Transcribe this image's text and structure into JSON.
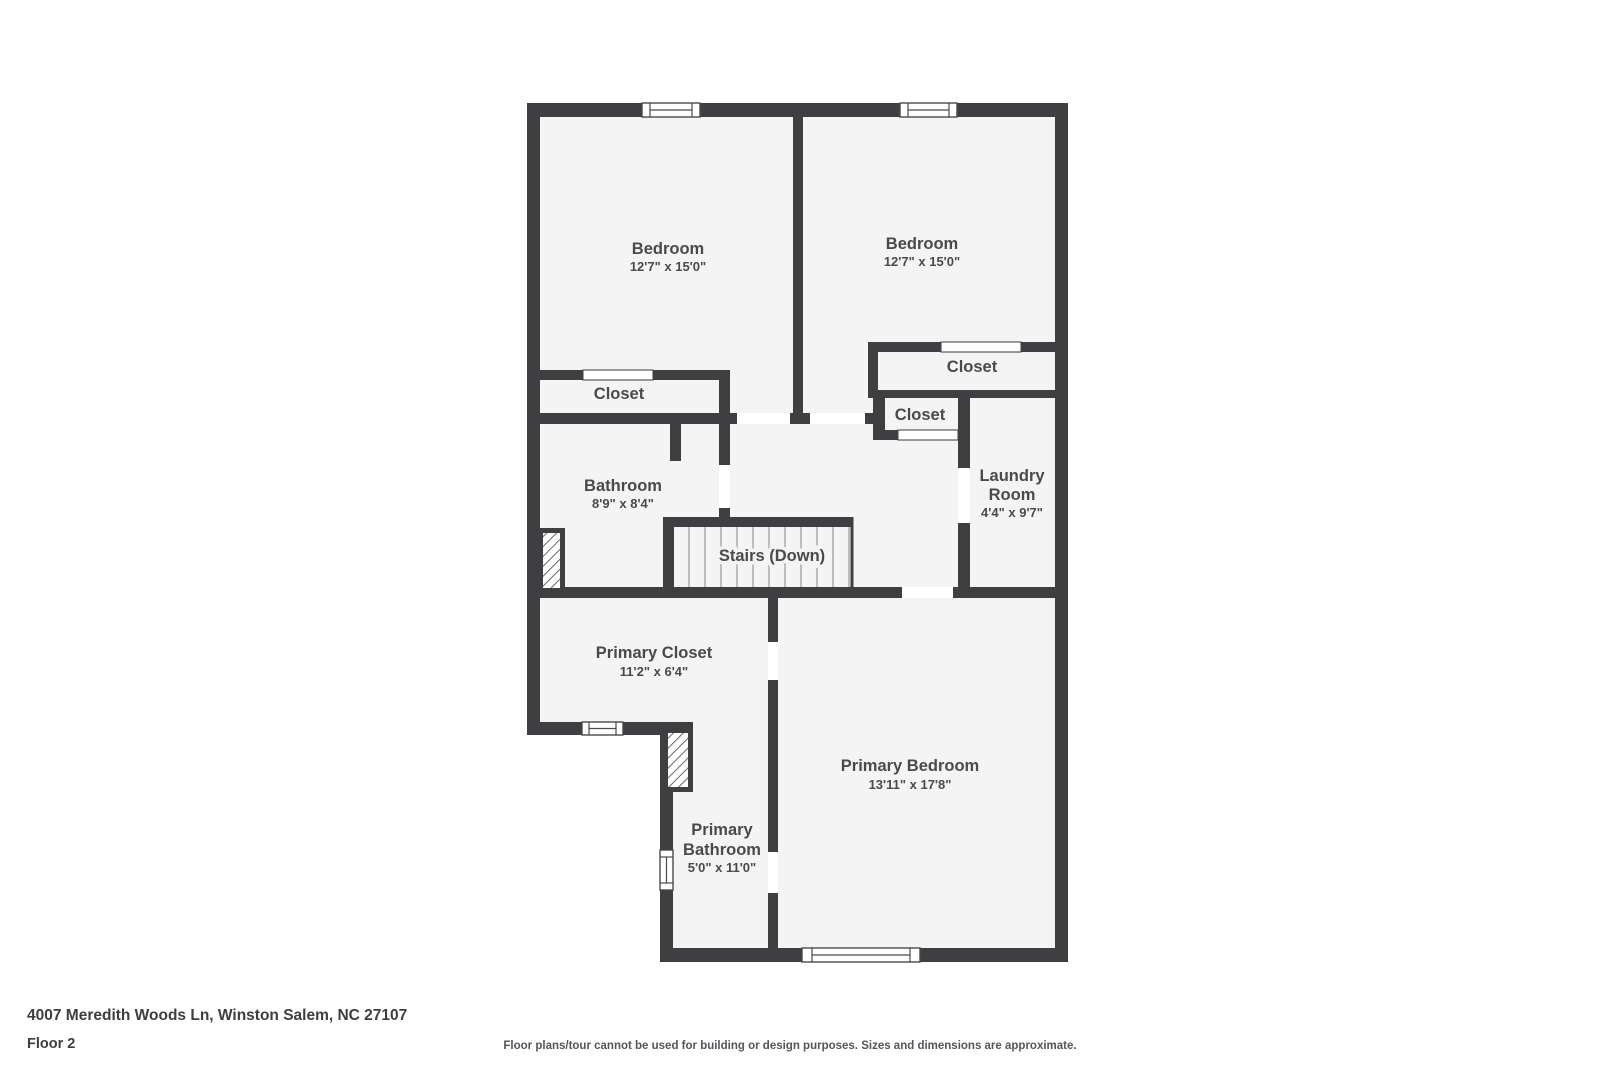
{
  "plan": {
    "colors": {
      "wall": "#3f3f41",
      "floor": "#f5f4f4",
      "label": "#4a4a4c",
      "tread": "#ababab"
    },
    "rooms": {
      "bedroom_left": {
        "name": "Bedroom",
        "dims": "12'7\" x 15'0\""
      },
      "bedroom_right": {
        "name": "Bedroom",
        "dims": "12'7\" x 15'0\""
      },
      "closet_left": {
        "name": "Closet"
      },
      "closet_right": {
        "name": "Closet"
      },
      "closet_middle": {
        "name": "Closet"
      },
      "bathroom": {
        "name": "Bathroom",
        "dims": "8'9\" x 8'4\""
      },
      "laundry_room": {
        "name_line1": "Laundry",
        "name_line2": "Room",
        "dims": "4'4\" x 9'7\""
      },
      "stairs": {
        "name": "Stairs (Down)"
      },
      "primary_closet": {
        "name": "Primary Closet",
        "dims": "11'2\" x 6'4\""
      },
      "primary_bedroom": {
        "name": "Primary Bedroom",
        "dims": "13'11\" x 17'8\""
      },
      "primary_bathroom": {
        "name_line1": "Primary",
        "name_line2": "Bathroom",
        "dims": "5'0\" x 11'0\""
      }
    }
  },
  "footer": {
    "address": "4007 Meredith Woods Ln, Winston Salem, NC 27107",
    "floor_label": "Floor 2",
    "disclaimer": "Floor plans/tour cannot be used for building or design purposes. Sizes and dimensions are approximate."
  }
}
